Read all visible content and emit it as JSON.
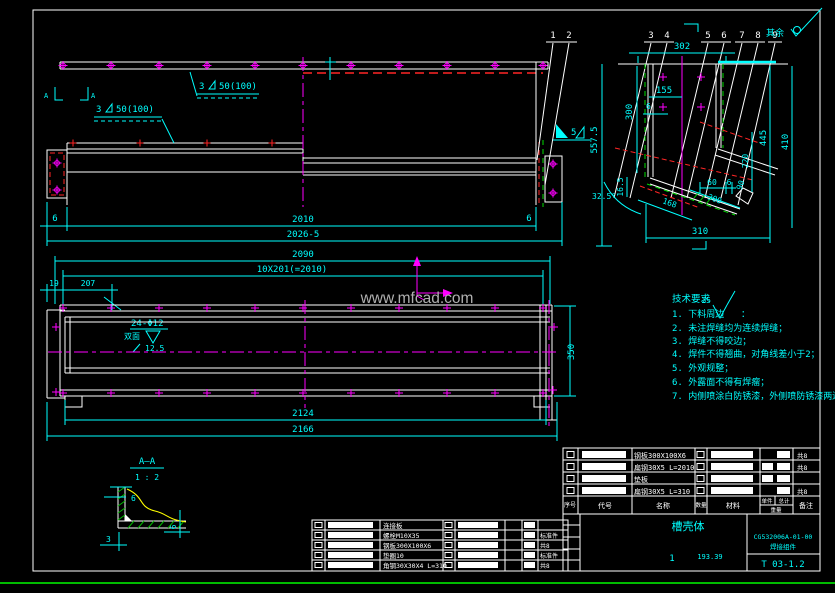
{
  "colors": {
    "background": "#000000",
    "line": "#ffffff",
    "dimension": "#00ffff",
    "center": "#ff00ff",
    "hidden": "#ff2525",
    "weld": "#00dd00",
    "break_line": "#ffff00",
    "watermark": "#b0b0b0",
    "divider": "#00bb00"
  },
  "watermark": "www.mfcad.com",
  "surface_finish": {
    "prefix": "其余"
  },
  "balloons": [
    "1",
    "2",
    "3",
    "4",
    "5",
    "6",
    "7",
    "8",
    "9"
  ],
  "front": {
    "weld_a_size": "3",
    "weld_a_spec": "50(100)",
    "weld_b_size": "3",
    "weld_b_spec": "50(100)",
    "weld_c_size": "5",
    "section_label": "A",
    "dim_gap_left": "6",
    "dim_gap_right": "6",
    "dim_inner": "2010",
    "dim_overall": "2026-5"
  },
  "plan": {
    "dim_overall": "2090",
    "dim_pitch": "10X201(=2010)",
    "dim_end_offset": "19",
    "dim_first_pitch": "207",
    "hole_callout": "24-Φ12",
    "hole_callout_side": "双面",
    "hole_callout_depth": "12.5",
    "dim_width": "350",
    "dim_inner": "2124",
    "dim_outer": "2166"
  },
  "section": {
    "dim_top_width": "302",
    "dim_155": "155",
    "dim_depth": "300",
    "dim_wall": "6",
    "dim_445": "445",
    "dim_410": "410",
    "dim_total_height": "557.5",
    "dim_165": "16.5",
    "dim_angle": "32.5°",
    "dim_168": "168",
    "dim_chute": "300",
    "dim_60": "60",
    "dim_6": "6",
    "dim_90": "90",
    "dim_220": "220",
    "dim_bottom": "310"
  },
  "detail_aa": {
    "title": "A—A",
    "scale": "1 : 2",
    "dim_wall": "6",
    "dim_floor": "6",
    "dim_3": "3"
  },
  "tech_notes": {
    "title": "技术要求",
    "note1_prefix": "1. 下料周边",
    "roughness": "25",
    "note1_suffix": "：",
    "lines": [
      "2. 未注焊缝均为连续焊缝；",
      "3. 焊缝不得咬边；",
      "4. 焊件不得翘曲，对角线差小于2；",
      "5. 外观规整；",
      "6. 外露面不得有焊瘤；",
      "7. 内侧喷涂白防锈漆，外侧喷防锈漆两遍。"
    ]
  },
  "title_block": {
    "headers": {
      "seq": "序号",
      "code": "代号",
      "name": "名称",
      "qty": "数量",
      "material": "材料",
      "unit_weight": "单件",
      "total_weight": "总计",
      "weight": "重量",
      "remark": "备注"
    },
    "rows": [
      {
        "name": "钢板300X100X6",
        "remark": "共8"
      },
      {
        "name": "扁钢30X5 L=2010",
        "remark": "共8"
      },
      {
        "name": "垫板",
        "remark": ""
      },
      {
        "name": "扁钢30X5 L=310",
        "remark": "共8"
      }
    ],
    "part_title": "槽壳体",
    "quantity": "1",
    "weight": "193.39",
    "drawing_no": "CG532006A-01-00",
    "subtitle": "焊接组件",
    "sheet_no": "T 03-1.2"
  },
  "bom": {
    "rows": [
      {
        "name": "连接板",
        "remark": ""
      },
      {
        "name": "螺栓M10X35",
        "remark": "标准件"
      },
      {
        "name": "钢板300X100X6",
        "remark": "共8"
      },
      {
        "name": "垫圈10",
        "remark": "标准件"
      },
      {
        "name": "角钢30X30X4 L=310",
        "remark": "共8"
      }
    ]
  }
}
